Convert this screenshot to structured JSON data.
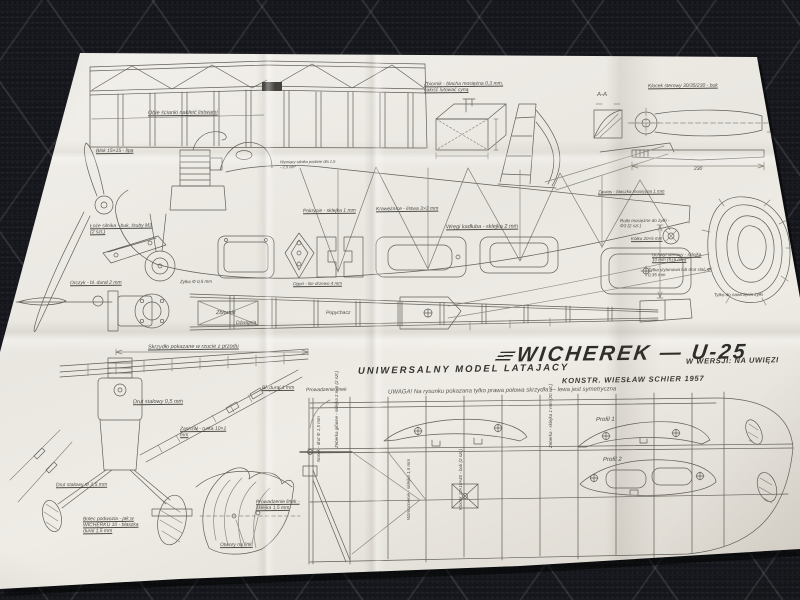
{
  "title_block": {
    "series": "UNIWERSALNY MODEL LATAJACY",
    "title": "WICHEREK — U-25",
    "constructor": "KONSTR. WIESŁAW SCHIER 1957",
    "version": "W WERSJI: NA UWIĘZI",
    "note": "UWAGA! Na rysunku pokazana tylko prawa połowa skrzydła — lewa jest symetryczna"
  },
  "annotations": {
    "truss_note": "Obie ścianki nakleić listwami",
    "block_note": "Blok 15×15 - lipa",
    "tank_note": "Zbiornik - blacha mosiężna 0,3 mm, całość lutować cyną",
    "handle_block": "Klocek sterowy 30/35/230 - buk",
    "section_aa": "A-A",
    "engine_mount": "Łoże silnika - buk, śruby M3 (2 szt.)",
    "formers": "Wręgi kadłuba - sklejka 2 mm",
    "stringers": "Krawężnice - listwa 3×3 mm",
    "covering": "Pokrycie - sklejka 1 mm",
    "engine_note": "Wymiary silnika podane dla 1,5 - 2,5 cm³",
    "bellcrank": "Orczyk - bl. dural 2 mm",
    "line_nylon_small": "Żyłka Φ 0,5 mm",
    "tail_solid": "Ogon - lite drzewo 4 mm",
    "tank_plan": "Zbiornik",
    "lever": "Dźwignia",
    "pushrod": "Popychacz",
    "wing_front_note": "Skrzydło pokazane w rzucie z przodu",
    "steel_wire_05": "Drut stalowy 0,5 mm",
    "dural_sheet": "Bl. dural 1 mm",
    "strut": "Zastrzał - rurka 10×1 mm",
    "steel_wire_15": "Drut stalowy Φ 1,5 mm",
    "gear_pin": "Bolec podwozia - jak w WICHERKU 10 - blaszka dural 1,5 mm",
    "line_guide_fin": "Prowadzenie linek - sklejka 1,5 mm",
    "line_holes": "Otwory na linki",
    "line_guide_wing": "Prowadzenie linek",
    "nose_wire": "Nosek - drut Φ 1,5 mm",
    "main_ribs": "Żeberka główne - sklejka 2 mm (2 szt.)",
    "reinforcement": "Wzmocnienie - sklejka 1,5 mm",
    "block_beech": "Klocek 10×10×45 - buk (2 szt.)",
    "ribs_right": "Żeberka - sklejka 1 mm (20 szt.)",
    "profile1": "Profil 1",
    "profile2": "Profil 2",
    "hinge": "Zawias - blaszka mosiężna 1 mm",
    "pulleys": "Rolki mosiężne do żyłki - Φ3 (2 szt.)",
    "tailwheel": "Kółko 20×5 mm",
    "handle": "Uchwyt sterowy - sklejka 10 mm (5+5 mm)",
    "control_line": "Żyłka stylonowa lub drut stal. Φ 0,35 mm",
    "winding_note": "Tylko do nawinięcia żyłki",
    "dim_230": "230"
  },
  "colors": {
    "paper": "#efece6",
    "carpet": "#14161b",
    "ink": "#5c5a53",
    "title_ink": "#2f2e2b"
  }
}
